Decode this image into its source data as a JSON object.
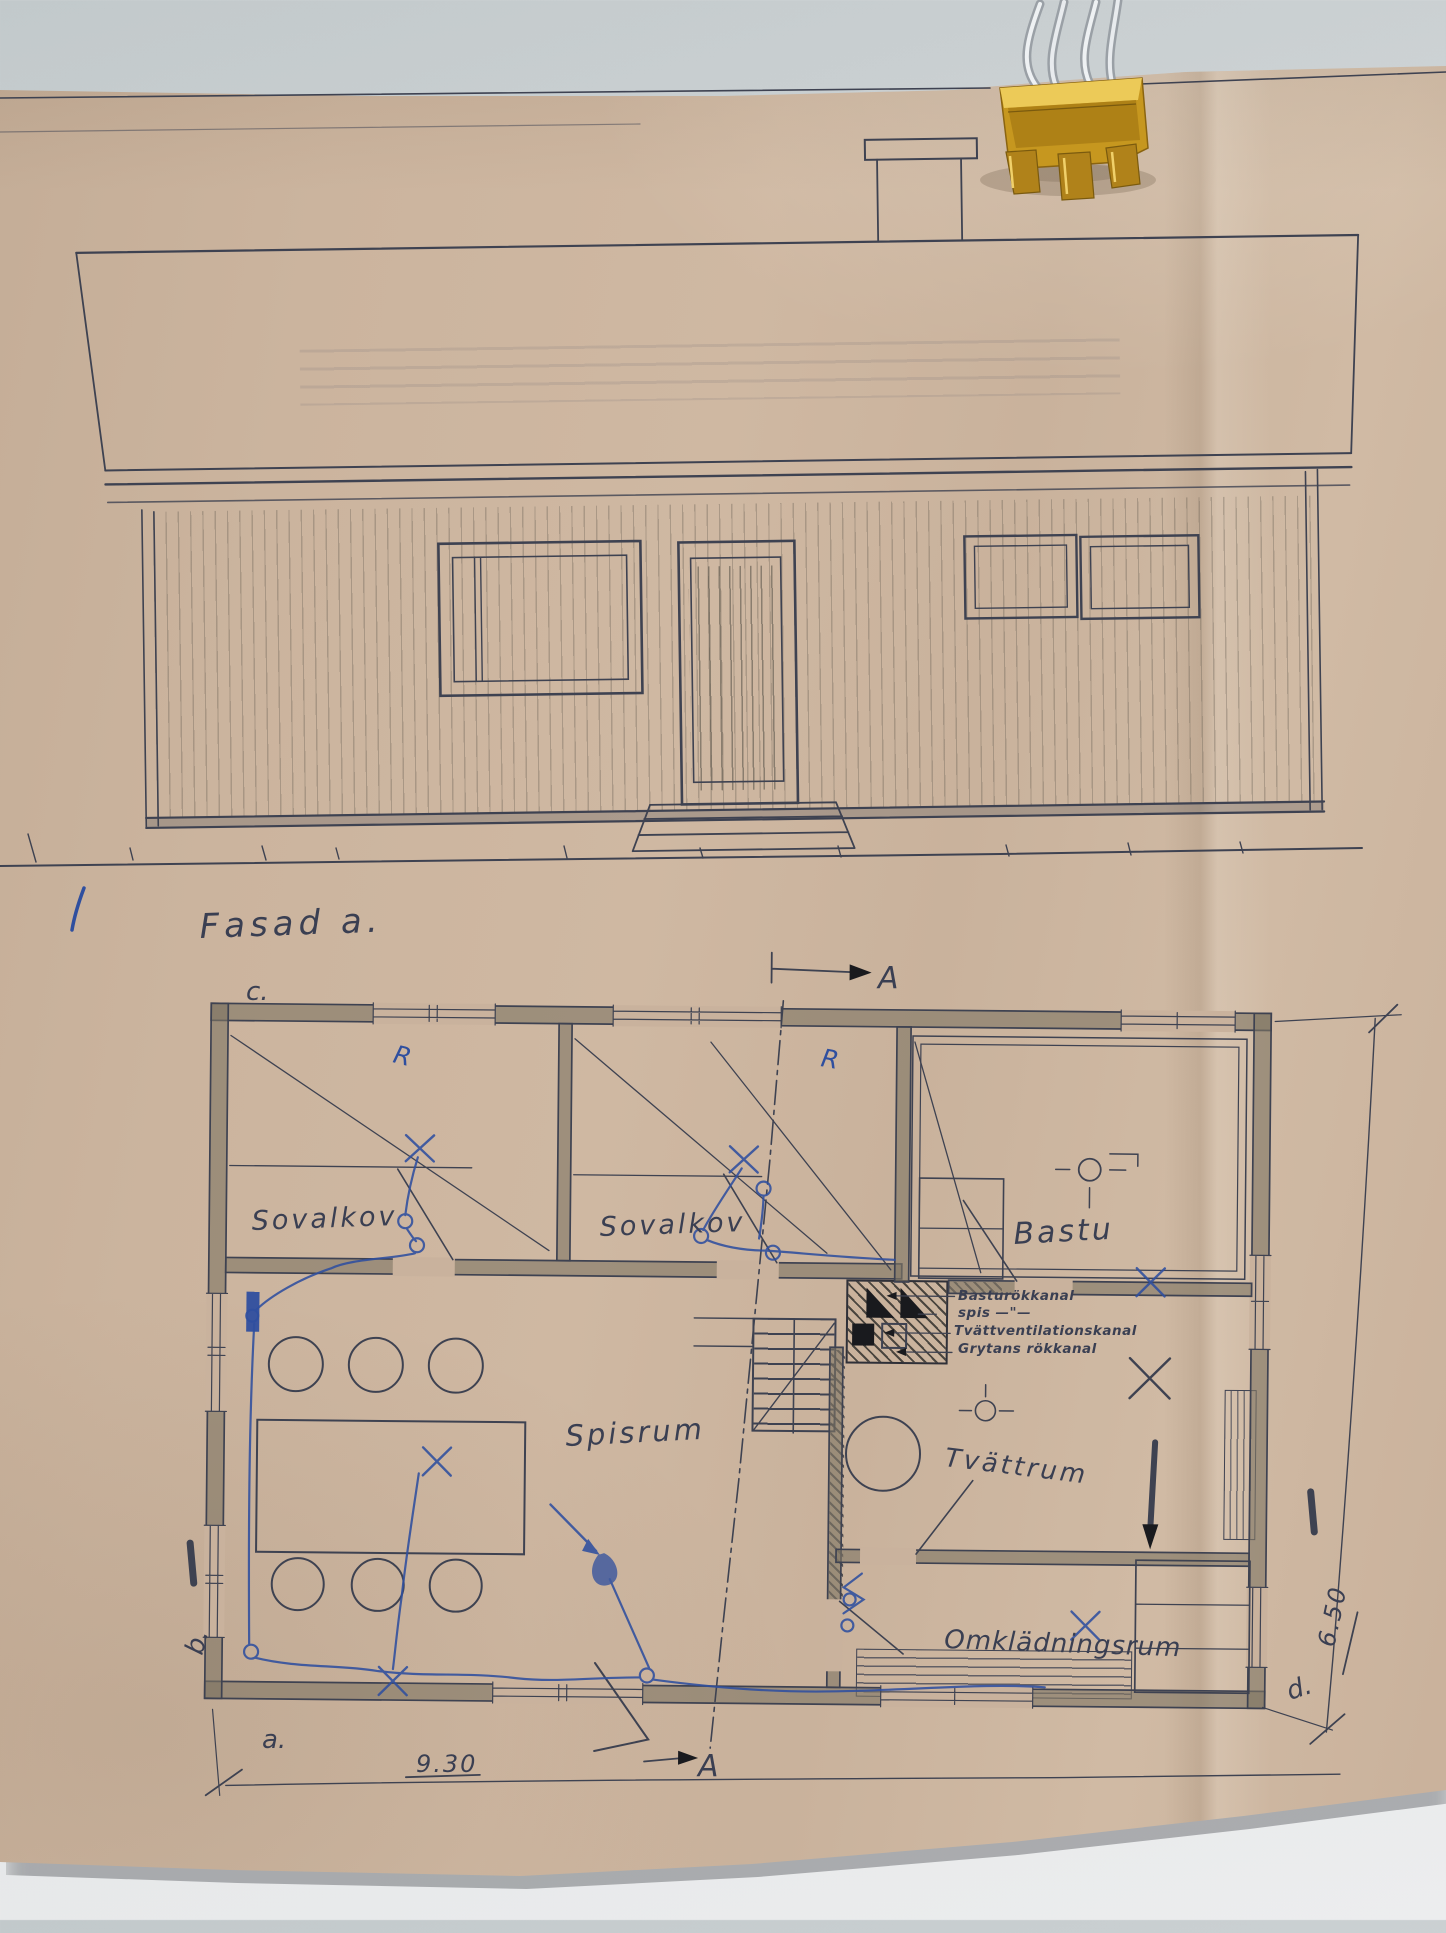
{
  "colors": {
    "paper": "#c9b29c",
    "wall": "#d3d7d9",
    "ink": "#3e4251",
    "blue_pen": "#2f4f9f",
    "clip_gold": "#c6971f"
  },
  "elevation": {
    "title": "Fasad a."
  },
  "plan": {
    "rooms": [
      {
        "id": "sovalkov-1",
        "label": "Sovalkov"
      },
      {
        "id": "sovalkov-2",
        "label": "Sovalkov"
      },
      {
        "id": "bastu",
        "label": "Bastu"
      },
      {
        "id": "spisrum",
        "label": "Spisrum"
      },
      {
        "id": "tvattrum",
        "label": "Tvättrum"
      },
      {
        "id": "omkladningsrum",
        "label": "Omklädningsrum"
      }
    ],
    "flue_annotations": [
      {
        "text": "Basturökkanal"
      },
      {
        "text": "spis —\"—"
      },
      {
        "text": "Tvättventilationskanal"
      },
      {
        "text": "Grytans rökkanal"
      }
    ],
    "dimensions": {
      "width_label": "9.30",
      "depth_label": "6.50"
    },
    "corners": {
      "a": "a.",
      "b": "b.",
      "c": "c.",
      "d": "d."
    },
    "section": {
      "top": "A",
      "bottom": "A"
    },
    "pen_marks": {
      "r1": "R",
      "r2": "R"
    }
  }
}
